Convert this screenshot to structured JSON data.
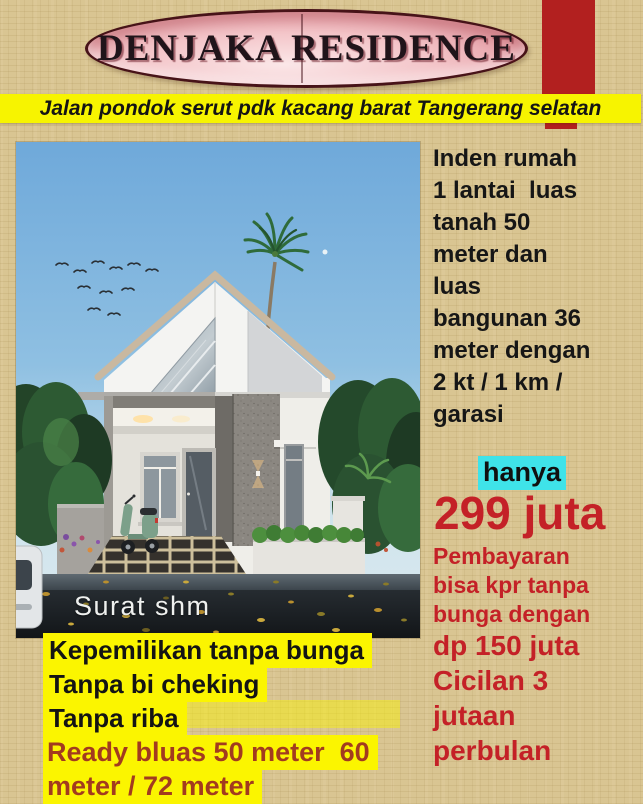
{
  "title_banner": {
    "text": "DENJAKA RESIDENCE"
  },
  "address_bar": {
    "text": "Jalan pondok serut pdk kacang barat Tangerang selatan"
  },
  "photo": {
    "caption": "Surat shm"
  },
  "details": {
    "lines": [
      "Inden rumah",
      "1 lantai  luas",
      "tanah 50",
      "meter dan",
      "luas",
      "bangunan 36",
      "meter dengan",
      "2 kt / 1 km /",
      "garasi"
    ]
  },
  "price": {
    "hanya_label": "hanya",
    "amount": "299 juta",
    "payment_lines": [
      "Pembayaran",
      "bisa kpr tanpa",
      "bunga dengan"
    ],
    "dp_line": "dp 150 juta",
    "installment_lines": [
      "Cicilan 3",
      "jutaan",
      "perbulan"
    ]
  },
  "offers": {
    "lines": [
      "Kepemilikan tanpa bunga",
      "Tanpa bi cheking",
      "Tanpa riba"
    ],
    "ready_lines": [
      "Ready bluas 50 meter  60",
      "meter / 72 meter"
    ]
  },
  "colors": {
    "background_tan": "#d9c592",
    "accent_bar_red": "#b2201f",
    "title_oval_pink": "#f3c3c7",
    "banner_yellow": "#f7f400",
    "highlight_cyan": "#3fe3e9",
    "price_red": "#c42127",
    "ready_text_red": "#a23b1f",
    "highlight_yellow": "#fbf500"
  }
}
